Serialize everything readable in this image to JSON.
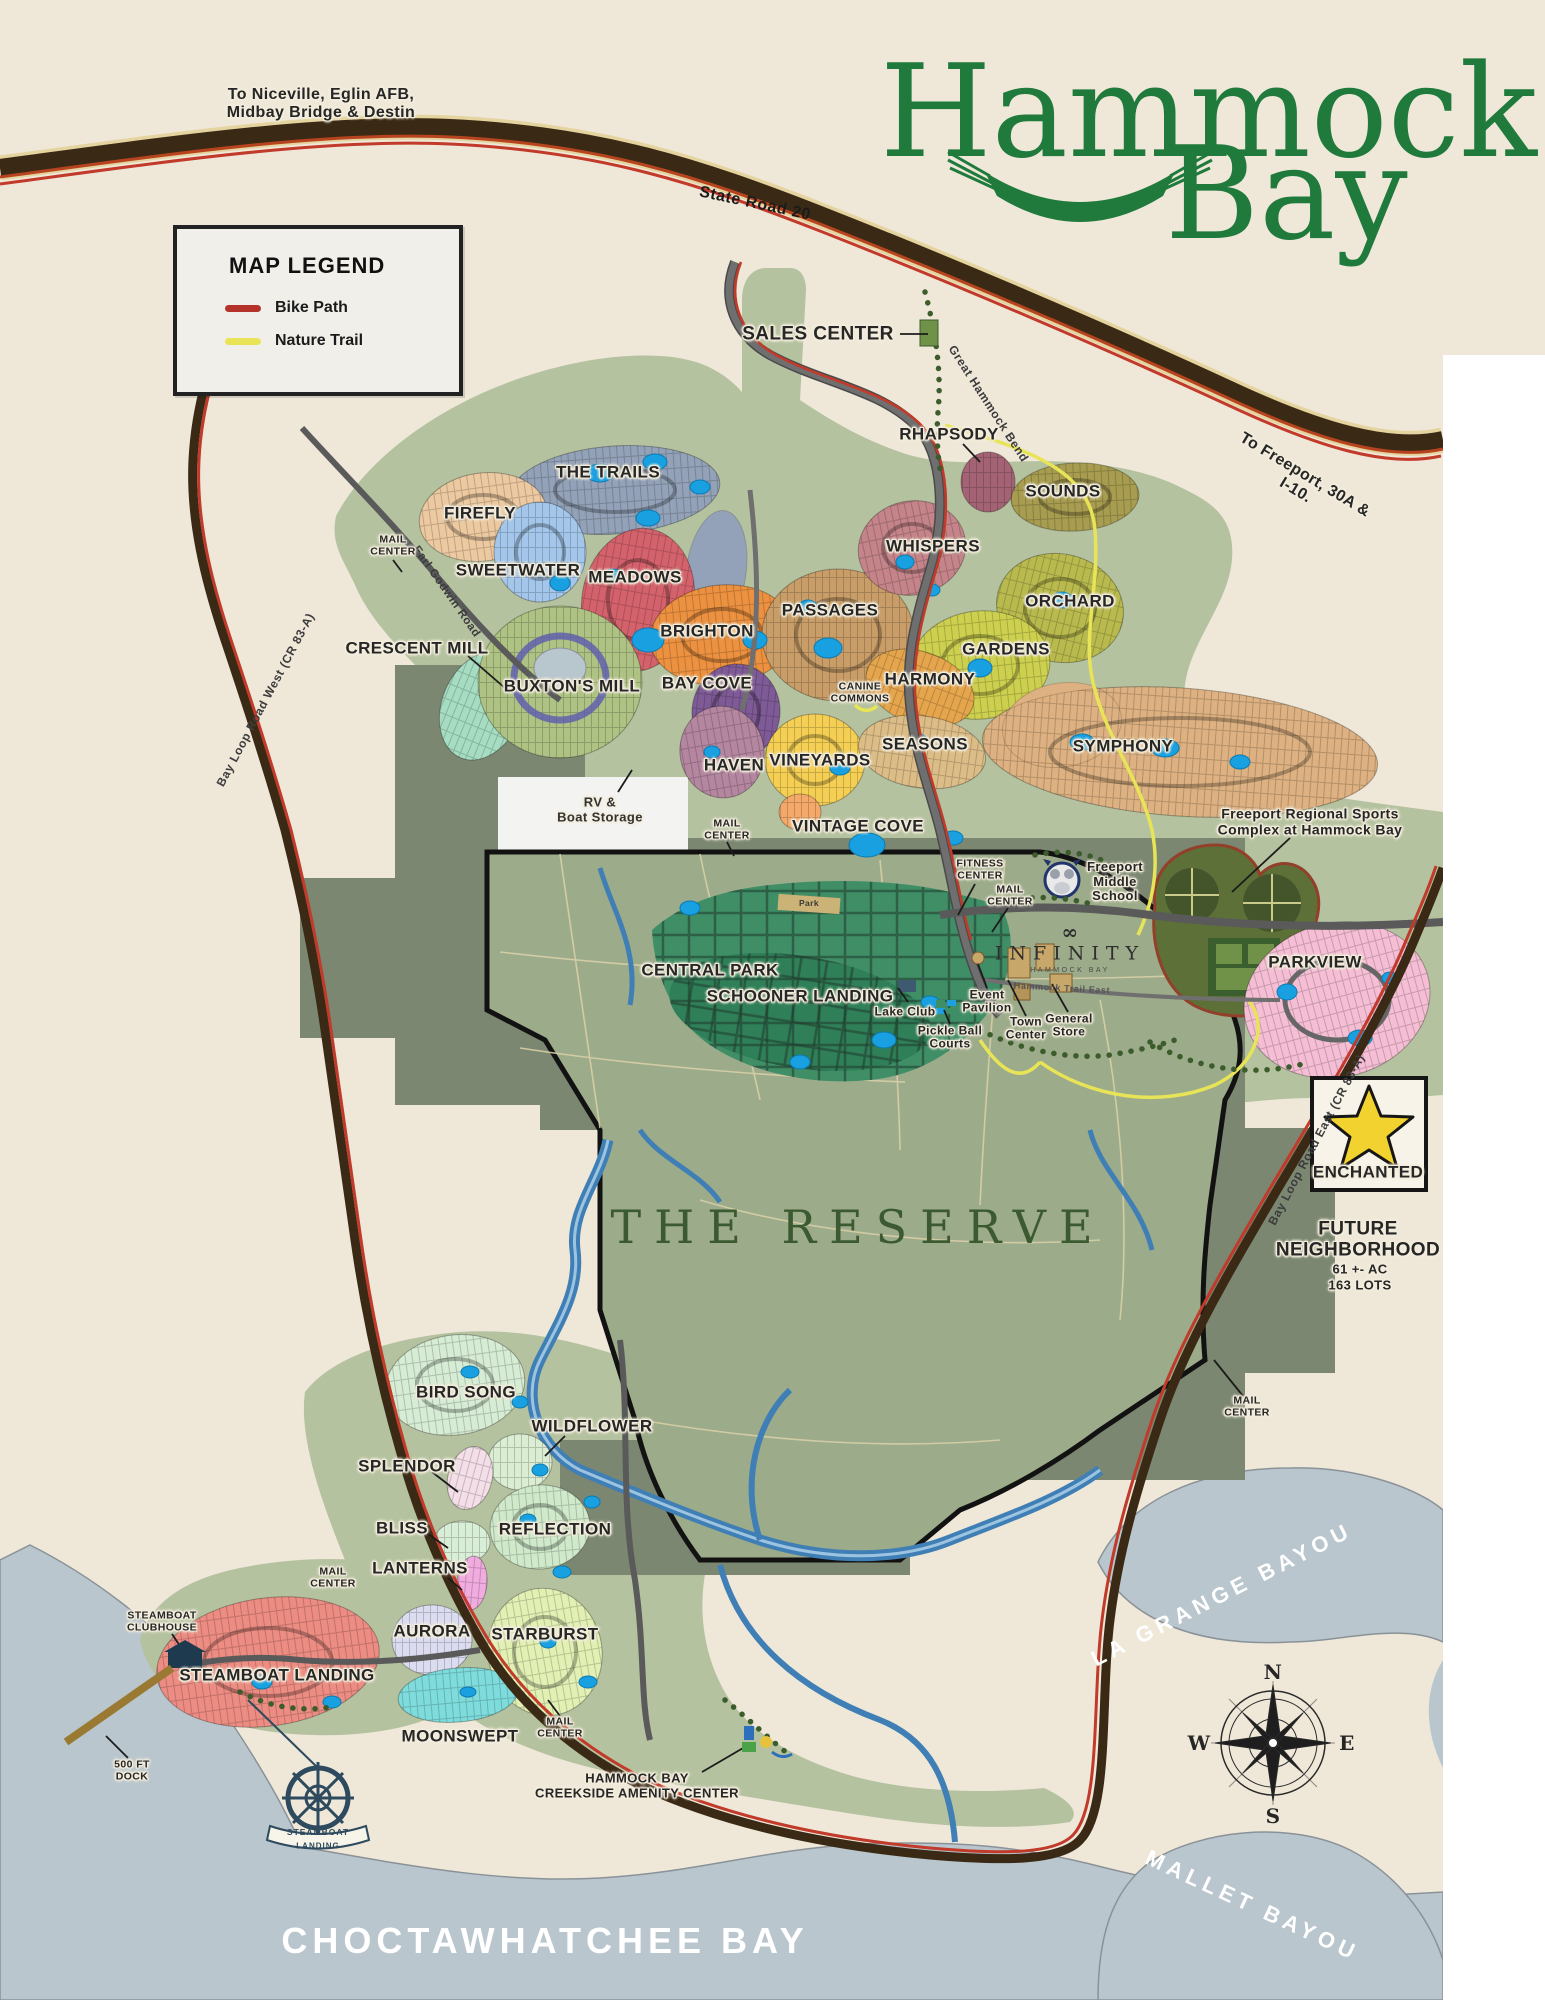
{
  "logo": {
    "word1": "Hammock",
    "word2": "Bay"
  },
  "directions": {
    "niceville": "To Niceville, Eglin AFB,\nMidbay Bridge & Destin",
    "freeport": "To Freeport, 30A &\nI-10."
  },
  "legend": {
    "title": "MAP LEGEND",
    "items": [
      {
        "label": "Bike Path",
        "color": "#b5322a"
      },
      {
        "label": "Nature Trail",
        "color": "#e9e457"
      }
    ]
  },
  "roads": {
    "state_road_20": "State Road 20",
    "great_hammock_bend": "Great Hammock Bend",
    "earl_godwin": "Earl Godwin Road",
    "bay_loop_west": "Bay Loop Road West  (CR 83-A)",
    "bay_loop_east": "Bay Loop Road East (CR 83-A)",
    "hammock_trail_east": "Hammock Trail East"
  },
  "neighborhoods": [
    {
      "name": "THE TRAILS",
      "color": "#93a2b8"
    },
    {
      "name": "FIREFLY",
      "color": "#ecc9a0"
    },
    {
      "name": "SWEETWATER",
      "color": "#a3c6ea"
    },
    {
      "name": "MEADOWS",
      "color": "#d4626c"
    },
    {
      "name": "BRIGHTON",
      "color": "#ec9140"
    },
    {
      "name": "BAY COVE",
      "color": "#7e5a96"
    },
    {
      "name": "CRESCENT MILL",
      "color": "#a6ddc2"
    },
    {
      "name": "BUXTON'S MILL",
      "color": "#aec284"
    },
    {
      "name": "HAVEN",
      "color": "#b4869f"
    },
    {
      "name": "VINEYARDS",
      "color": "#f4cf54"
    },
    {
      "name": "VINTAGE COVE",
      "color": "#f4a96a"
    },
    {
      "name": "PASSAGES",
      "color": "#c89d67"
    },
    {
      "name": "WHISPERS",
      "color": "#c48489"
    },
    {
      "name": "RHAPSODY",
      "color": "#a46375"
    },
    {
      "name": "SOUNDS",
      "color": "#a79c4f"
    },
    {
      "name": "ORCHARD",
      "color": "#b9ba4e"
    },
    {
      "name": "GARDENS",
      "color": "#cdd04e"
    },
    {
      "name": "HARMONY",
      "color": "#e5a54c"
    },
    {
      "name": "SEASONS",
      "color": "#dcbd87"
    },
    {
      "name": "SYMPHONY",
      "color": "#ddb181"
    },
    {
      "name": "CENTRAL PARK",
      "color": "#3f8e66"
    },
    {
      "name": "SCHOONER LANDING",
      "color": "#2f7f58"
    },
    {
      "name": "PARKVIEW",
      "color": "#f5bed4"
    },
    {
      "name": "BIRD SONG",
      "color": "#d6ecd4"
    },
    {
      "name": "WILDFLOWER",
      "color": "#dbeed4"
    },
    {
      "name": "SPLENDOR",
      "color": "#f4dee8"
    },
    {
      "name": "BLISS",
      "color": "#d9eed6"
    },
    {
      "name": "REFLECTION",
      "color": "#cfe9ca"
    },
    {
      "name": "LANTERNS",
      "color": "#f0abdf"
    },
    {
      "name": "AURORA",
      "color": "#dcdcf0"
    },
    {
      "name": "STARBURST",
      "color": "#e2f0b4"
    },
    {
      "name": "MOONSWEPT",
      "color": "#7fdcdc"
    },
    {
      "name": "STEAMBOAT LANDING",
      "color": "#ec8c82"
    }
  ],
  "amenities": {
    "sales_center": "SALES CENTER",
    "mail_center": "MAIL\nCENTER",
    "rv_boat_storage": "RV &\nBoat Storage",
    "canine_commons": "CANINE\nCOMMONS",
    "fitness_center": "FITNESS\nCENTER",
    "lake_club": "Lake Club",
    "pickle_ball": "Pickle Ball\nCourts",
    "event_pavilion": "Event\nPavilion",
    "town_center": "Town\nCenter",
    "general_store": "General\nStore",
    "park": "Park",
    "middle_school": "Freeport\nMiddle\nSchool",
    "sports_complex": "Freeport Regional Sports\nComplex at Hammock Bay",
    "infinity": "INFINITY",
    "infinity_sub": "HAMMOCK BAY",
    "steamboat_clubhouse": "STEAMBOAT\nCLUBHOUSE",
    "steamboat_badge_top": "STEAMBOAT",
    "steamboat_badge_bottom": "LANDING",
    "dock": "500 FT\nDOCK",
    "creekside": "HAMMOCK BAY\nCREEKSIDE AMENITY CENTER"
  },
  "reserve": {
    "label": "THE RESERVE"
  },
  "future": {
    "star_label": "ENCHANTED",
    "star_color": "#f2d22e",
    "title": "FUTURE\nNEIGHBORHOOD",
    "acreage": "61 +- AC",
    "lots": "163 LOTS"
  },
  "water": {
    "bay": "CHOCTAWHATCHEE BAY",
    "la_grange": "LA GRANGE BAYOU",
    "mallet": "MALLET BAYOU"
  },
  "compass": {
    "n": "N",
    "e": "E",
    "s": "S",
    "w": "W"
  }
}
